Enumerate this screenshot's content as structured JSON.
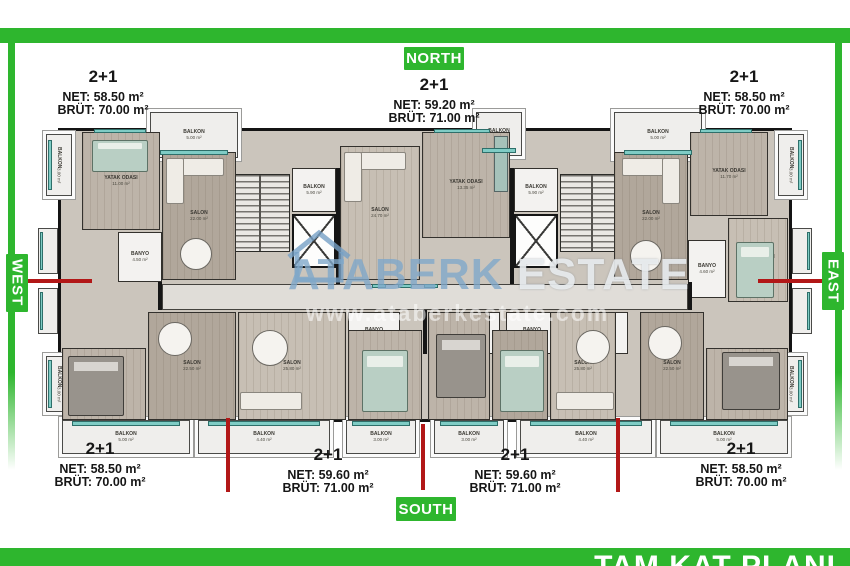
{
  "frame": {
    "color": "#2eb62e",
    "footer_title": "TAM KAT PLANI"
  },
  "directions": {
    "north": "NORTH",
    "south": "SOUTH",
    "west": "WEST",
    "east": "EAST"
  },
  "units": {
    "top_left": {
      "type": "2+1",
      "net": "NET: 58.50 m²",
      "brut": "BRÜT: 70.00 m²"
    },
    "top_center": {
      "type": "2+1",
      "net": "NET: 59.20 m²",
      "brut": "BRÜT: 71.00 m²"
    },
    "top_right": {
      "type": "2+1",
      "net": "NET: 58.50 m²",
      "brut": "BRÜT: 70.00 m²"
    },
    "bottom_left": {
      "type": "2+1",
      "net": "NET: 58.50 m²",
      "brut": "BRÜT: 70.00 m²"
    },
    "bottom_center_left": {
      "type": "2+1",
      "net": "NET: 59.60 m²",
      "brut": "BRÜT: 71.00 m²"
    },
    "bottom_center_right": {
      "type": "2+1",
      "net": "NET: 59.60 m²",
      "brut": "BRÜT: 71.00 m²"
    },
    "bottom_right": {
      "type": "2+1",
      "net": "NET: 58.50 m²",
      "brut": "BRÜT: 70.00 m²"
    }
  },
  "watermark": {
    "brand": "ATABERK",
    "brand2": "ESTATE",
    "website": "www.ataberkestate.com"
  },
  "rooms": {
    "nw_side_balkon": {
      "label": "BALKON",
      "area": "3.00 m²"
    },
    "nw_bedroom": {
      "label": "YATAK ODASI",
      "area": "11.00 m²"
    },
    "nw_top_balkon": {
      "label": "BALKON",
      "area": "5.00 m²"
    },
    "nw_salon": {
      "label": "SALON",
      "area": "22.00 m²"
    },
    "nw_banyo": {
      "label": "BANYO",
      "area": "4.50 m²"
    },
    "left_core_balkon": {
      "label": "BALKON",
      "area": "5.90 m²"
    },
    "n_salon": {
      "label": "SALON",
      "area": "24.70 m²"
    },
    "n_bedroom": {
      "label": "YATAK ODASI",
      "area": "13.35 m²"
    },
    "n_top_balkon": {
      "label": "BALKON",
      "area": "2.90 m²"
    },
    "right_core_balkon": {
      "label": "BALKON",
      "area": "5.90 m²"
    },
    "ne_salon": {
      "label": "SALON",
      "area": "22.00 m²"
    },
    "ne_bedroom1": {
      "label": "YATAK ODASI",
      "area": "11.70 m²"
    },
    "ne_top_balkon": {
      "label": "BALKON",
      "area": "5.00 m²"
    },
    "ne_bedroom2": {
      "label": "YATAK ODASI",
      "area": "12.00 m²"
    },
    "ne_banyo": {
      "label": "BANYO",
      "area": "4.60 m²"
    },
    "ne_side_balkon": {
      "label": "BALKON",
      "area": "3.00 m²"
    },
    "sw_side_balkon": {
      "label": "BALKON",
      "area": "3.00 m²"
    },
    "se_side_balkon": {
      "label": "BALKON",
      "area": "3.00 m²"
    },
    "sw_bedroom": {
      "label": "YATAK ODASI",
      "area": "12.00 m²"
    },
    "sw_salon": {
      "label": "SALON",
      "area": "22.50 m²"
    },
    "s1_salon": {
      "label": "SALON",
      "area": "25.80 m²"
    },
    "s1_bedroom": {
      "label": "YATAK ODASI",
      "area": "10.40 m²"
    },
    "s2_bedroom1": {
      "label": "YATAK ODASI",
      "area": "13.30 m²"
    },
    "s2_bedroom2": {
      "label": "YATAK ODASI",
      "area": "10.40 m²"
    },
    "s2_salon": {
      "label": "SALON",
      "area": "25.80 m²"
    },
    "se_salon": {
      "label": "SALON",
      "area": "22.50 m²"
    },
    "se_bedroom": {
      "label": "YATAK ODASI",
      "area": "12.00 m²"
    },
    "wet1": {
      "label": "BANYO",
      "area": "1.75 m²"
    },
    "wet2": {
      "label": "BANYO",
      "area": "4.02 m²"
    },
    "wet3": {
      "label": "WC",
      "area": "1.40 m²"
    },
    "wet4": {
      "label": "BANYO",
      "area": "4.02 m²"
    },
    "wet5": {
      "label": "BANYO",
      "area": "1.75 m²"
    },
    "sb1": {
      "label": "BALKON",
      "area": "5.00 m²"
    },
    "sb2": {
      "label": "BALKON",
      "area": "4.40 m²"
    },
    "sb3": {
      "label": "BALKON",
      "area": "3.00 m²"
    },
    "sb4": {
      "label": "BALKON",
      "area": "3.00 m²"
    },
    "sb5": {
      "label": "BALKON",
      "area": "4.40 m²"
    },
    "sb6": {
      "label": "BALKON",
      "area": "5.00 m²"
    }
  }
}
